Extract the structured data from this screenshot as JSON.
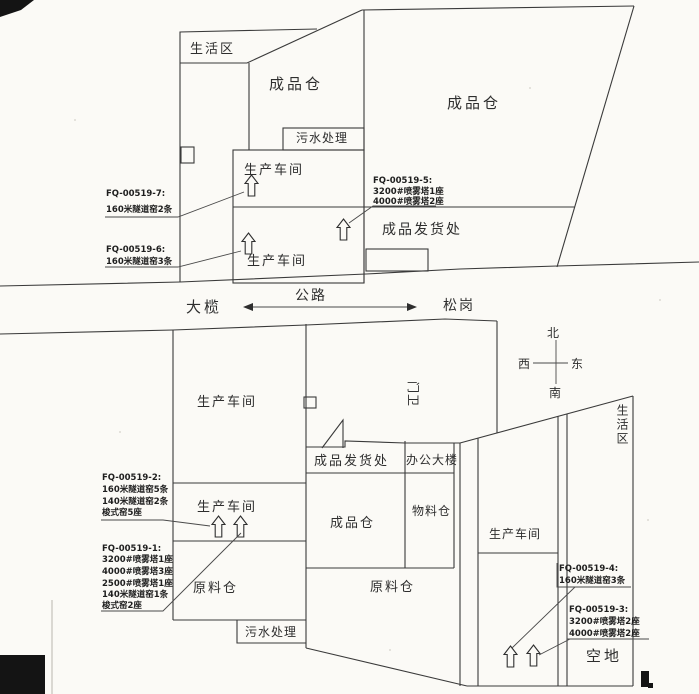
{
  "colors": {
    "ink": "#3a3a3a",
    "paper": "#fbfaf6"
  },
  "site_north": {
    "areas": {
      "living": "生活区",
      "finished_left": "成品仓",
      "finished_right": "成品仓",
      "sewage": "污水处理",
      "workshop_upper": "生产车间",
      "workshop_lower": "生产车间",
      "shipping": "成品发货处"
    },
    "callouts": {
      "fq7": {
        "id": "FQ-00519-7:",
        "lines": [
          "160米隧道窑2条"
        ]
      },
      "fq6": {
        "id": "FQ-00519-6:",
        "lines": [
          "160米隧道窑3条"
        ]
      },
      "fq5": {
        "id": "FQ-00519-5:",
        "lines": [
          "3200#喷雾塔1座",
          "4000#喷雾塔2座"
        ]
      }
    }
  },
  "road": {
    "west_town": "大榄",
    "name": "公路",
    "east_town": "松岗"
  },
  "compass": {
    "north": "北",
    "south": "南",
    "west": "西",
    "east": "东"
  },
  "site_south": {
    "areas": {
      "workshop_main": "生产车间",
      "workshop_small": "生产车间",
      "raw_left": "原料仓",
      "sewage": "污水处理",
      "shipping": "成品发货处",
      "finished": "成品仓",
      "office": "办公大楼",
      "material": "物料仓",
      "raw_right": "原料仓",
      "workshop_east": "生产车间",
      "living": "生活区",
      "vacant": "空地",
      "gatehouse": "门卫"
    },
    "callouts": {
      "fq2": {
        "id": "FQ-00519-2:",
        "lines": [
          "160米隧道窑5条",
          "140米隧道窑2条",
          "梭式窑5座"
        ]
      },
      "fq1": {
        "id": "FQ-00519-1:",
        "lines": [
          "3200#喷雾塔1座",
          "4000#喷雾塔3座",
          "2500#喷雾塔1座",
          "140米隧道窑1条",
          "梭式窑2座"
        ]
      },
      "fq4": {
        "id": "FQ-00519-4:",
        "lines": [
          "160米隧道窑3条"
        ]
      },
      "fq3": {
        "id": "FQ-00519-3:",
        "lines": [
          "3200#喷雾塔2座",
          "4000#喷雾塔2座"
        ]
      }
    }
  }
}
